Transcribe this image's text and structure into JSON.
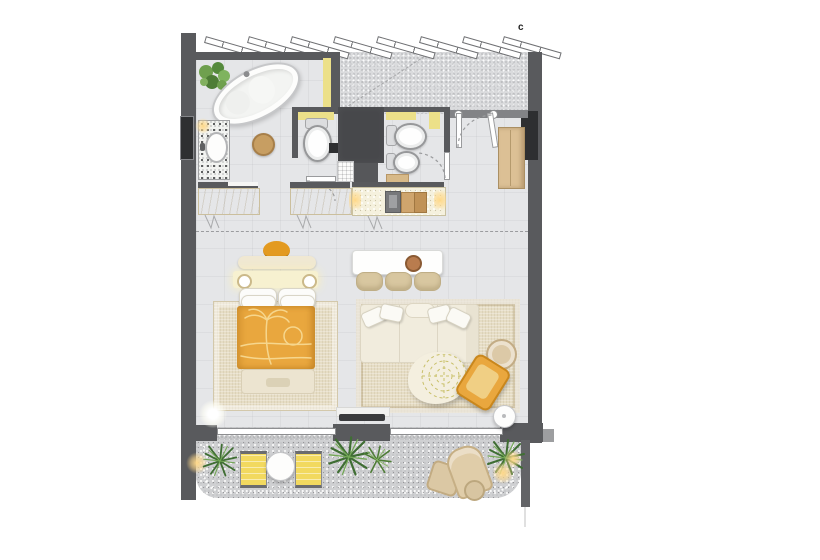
{
  "floor_plan": {
    "view": "top-down apartment floor plan rendering",
    "corner_mark": "c"
  },
  "colors": {
    "wall": "#595a5d",
    "wall-dark": "#2e2f31",
    "wall-yellow": "#ece089",
    "floor": "#e5e6e8",
    "floor-balcony": "#cfd0d2",
    "rug": "#e6ddc5",
    "accent-orange": "#e9a73e",
    "accent-yellow": "#f2d95f",
    "cream": "#f0e8d2",
    "wood": "#dcc095",
    "plant-green": "#3f6e33"
  }
}
